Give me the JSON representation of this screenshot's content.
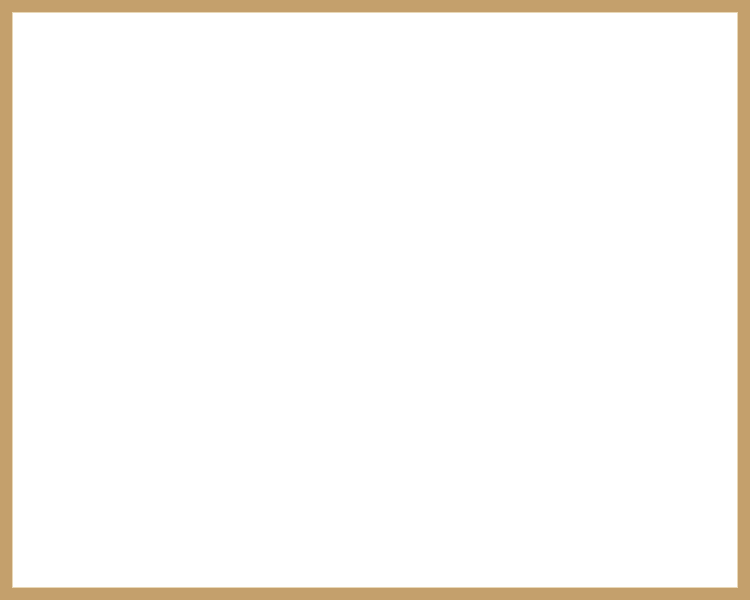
{
  "legend": {
    "title": "Legend",
    "items": [
      "01. Aquamarine Centre",
      "02. Lakeside Leisure",
      "03. Swimming Pool",
      "04. Basketball Court",
      "05. Tennis Court",
      "06. Volleyball Court",
      "07. Fun and Frolic Zone",
      "08. Provision for Supermarket",
      "09. Entry and Exit Points",
      "10. Future Development"
    ]
  },
  "footer": {
    "note": "Master plan is subject to change"
  },
  "compass": {
    "north": "N",
    "south": "S",
    "east": "E",
    "west": "W"
  },
  "labels": {
    "lake_top": "LAKE",
    "lake_bottom": "LAKE",
    "entry_left": "ENTRY",
    "exit_bottom": "EXIT",
    "entry_bottom": "ENTRY",
    "entry_right": "ENTRY",
    "exit_right": "EXIT",
    "services_top": "SERVICES",
    "services_mid": "SERVICES",
    "kids_play_line1": "KIDS",
    "kids_play_line2": "PLAY AREA"
  },
  "markers": [
    {
      "n": "9",
      "x": 43,
      "y": 184
    },
    {
      "n": "10",
      "x": 59,
      "y": 154
    },
    {
      "n": "10",
      "x": 94,
      "y": 154
    },
    {
      "n": "10",
      "x": 120,
      "y": 154
    },
    {
      "n": "10",
      "x": 137,
      "y": 131
    },
    {
      "n": "7",
      "x": 102,
      "y": 254
    },
    {
      "n": "4",
      "x": 51,
      "y": 265
    },
    {
      "n": "8",
      "x": 41,
      "y": 292
    },
    {
      "n": "5",
      "x": 77,
      "y": 308
    },
    {
      "n": "10",
      "x": 127,
      "y": 294
    },
    {
      "n": "10",
      "x": 157,
      "y": 299
    },
    {
      "n": "3",
      "x": 204,
      "y": 314
    },
    {
      "n": "2",
      "x": 228,
      "y": 318
    },
    {
      "n": "6",
      "x": 207,
      "y": 366
    },
    {
      "n": "10",
      "x": 408,
      "y": 295
    },
    {
      "n": "3",
      "x": 131,
      "y": 409
    },
    {
      "n": "1",
      "x": 153,
      "y": 419
    },
    {
      "n": "10",
      "x": 77,
      "y": 447
    },
    {
      "n": "10",
      "x": 214,
      "y": 449
    },
    {
      "n": "10",
      "x": 214,
      "y": 466
    },
    {
      "n": "10",
      "x": 219,
      "y": 486
    },
    {
      "n": "9",
      "x": 277,
      "y": 493
    },
    {
      "n": "9",
      "x": 408,
      "y": 397
    }
  ],
  "colors": {
    "frame_tan": "#c4a06c",
    "lake_blue": "#9fcfe4",
    "sand": "#f1e4a6",
    "marker_fill": "#f28b1e",
    "marker_ring": "#ffffff",
    "building_yellow": "#f2e58c",
    "building_orange": "#eeb763",
    "building_pink": "#f1cbc4",
    "building_cream": "#f4edca",
    "building_gray": "#ccccc6",
    "road_gray": "#cfccc2"
  }
}
